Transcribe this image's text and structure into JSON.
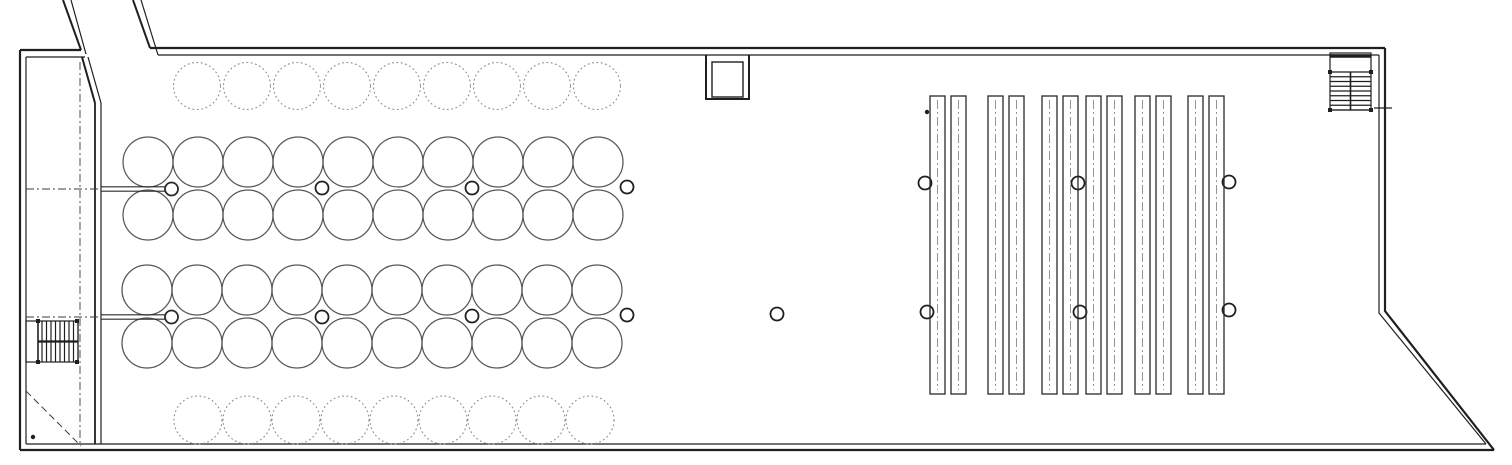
{
  "page": {
    "background": "#ffffff"
  },
  "plan": {
    "canvas": {
      "w": 1512,
      "h": 465
    },
    "ink": "#1f1f1f",
    "walls": {
      "color": "#1f1f1f",
      "segments": [
        {
          "d": "M150 48 H1385",
          "w": 2.2
        },
        {
          "d": "M158 55 H1379",
          "w": 1.2
        },
        {
          "d": "M1385 48 V311 L1494 450",
          "w": 2.2
        },
        {
          "d": "M1379 55 V313 L1486 444",
          "w": 1.2
        },
        {
          "d": "M20 450 H1494",
          "w": 2.2
        },
        {
          "d": "M26 444 H1486",
          "w": 1.2
        },
        {
          "d": "M20 50 V450",
          "w": 2.2
        },
        {
          "d": "M26 57 V444",
          "w": 1.2
        },
        {
          "d": "M20 50 H81",
          "w": 2.2
        },
        {
          "d": "M26 57 H85",
          "w": 1.2
        },
        {
          "d": "M63 0 L81 50",
          "w": 2.0
        },
        {
          "d": "M71 0 L86 54",
          "w": 1.2
        },
        {
          "d": "M133 0 L150 48",
          "w": 2.0
        },
        {
          "d": "M141 0 L158 55",
          "w": 1.2
        },
        {
          "d": "M82 57 L95 103",
          "w": 2.0
        },
        {
          "d": "M88 57 L101 103",
          "w": 1.2
        },
        {
          "d": "M95 103 V444",
          "w": 1.8
        },
        {
          "d": "M101 103 V444",
          "w": 1.2
        }
      ]
    },
    "centerlines": {
      "color": "#3c3c3c",
      "width": 0.9,
      "dash": "8 3 2 3",
      "lines": [
        "M26 189 H101",
        "M26 317 H101",
        "M80 62 V443"
      ]
    },
    "ramp_arrow": {
      "color": "#3c3c3c",
      "width": 1.0,
      "dash": "7 4",
      "d": "M26 391 L81 446"
    },
    "tanks": {
      "solid_color": "#575757",
      "solid_width": 1.25,
      "dashed_color": "#8f8f8f",
      "dashed_width": 1.1,
      "dash": "1.8 2.6",
      "rows": [
        {
          "style": "dashed",
          "cy": 86,
          "r": 23.5,
          "start": 197,
          "step": 50,
          "count": 9
        },
        {
          "style": "solid",
          "cy": 162,
          "r": 25,
          "start": 148,
          "step": 50,
          "count": 10
        },
        {
          "style": "solid",
          "cy": 215,
          "r": 25,
          "start": 148,
          "step": 50,
          "count": 10
        },
        {
          "style": "solid",
          "cy": 290,
          "r": 25,
          "start": 147,
          "step": 50,
          "count": 10
        },
        {
          "style": "solid",
          "cy": 343,
          "r": 25,
          "start": 147,
          "step": 50,
          "count": 10
        },
        {
          "style": "dashed",
          "cy": 420,
          "r": 24,
          "start": 198,
          "step": 49,
          "count": 9
        }
      ]
    },
    "pipes": {
      "color": "#2a2a2a",
      "line_width": 1.1,
      "half_gap": 2.2,
      "end_circle_r": 6.5,
      "end_circle_w": 1.8,
      "items": [
        {
          "y": 189,
          "x1": 101,
          "x2": 164.5,
          "cx": 171.5
        },
        {
          "y": 317,
          "x1": 101,
          "x2": 164.5,
          "cx": 171.5
        }
      ]
    },
    "columns": {
      "color": "#1f1f1f",
      "r": 6.5,
      "stroke_w": 1.8,
      "points": [
        [
          322,
          188
        ],
        [
          472,
          188
        ],
        [
          627,
          187
        ],
        [
          925,
          183
        ],
        [
          1078,
          183
        ],
        [
          1229,
          182
        ],
        [
          322,
          317
        ],
        [
          472,
          316
        ],
        [
          627,
          315
        ],
        [
          777,
          314
        ],
        [
          927,
          312
        ],
        [
          1080,
          312
        ],
        [
          1229,
          310
        ]
      ]
    },
    "racks": {
      "color": "#2a2a2a",
      "stroke_w": 1.3,
      "centerline_color": "#7a7a7a",
      "centerline_dash": "9 3 2 3",
      "top": 96,
      "bottom": 394,
      "rect_w": 15,
      "gap": 6,
      "pairs_x": [
        930,
        988,
        1042,
        1086,
        1135,
        1188
      ]
    },
    "shaft": {
      "color": "#1f1f1f",
      "outer": "M706 55 V99 H749 V55",
      "outer_w": 2.0,
      "inner": {
        "x": 712,
        "y": 62,
        "w": 31,
        "h": 35,
        "stroke_w": 1.4
      }
    },
    "stairs_ne": {
      "x": 1330,
      "y": 53,
      "w": 41,
      "h": 57,
      "landing_bar_y": 56,
      "landing_bar_w": 3.5,
      "tread_start": 72,
      "tread_step": 4.75,
      "tread_count": 9,
      "divider_x": 1350.5,
      "posts": [
        [
          1330,
          72
        ],
        [
          1371,
          72
        ],
        [
          1330,
          110
        ],
        [
          1371,
          110
        ]
      ],
      "post_size": 4
    },
    "stairs_sw": {
      "x": 26,
      "y": 321,
      "w": 52,
      "h": 41,
      "rail_x": 38,
      "tread_start": 42,
      "tread_step": 4.5,
      "tread_count": 9,
      "divider_y": 341.5,
      "posts": [
        [
          38,
          321
        ],
        [
          77,
          321
        ],
        [
          38,
          362
        ],
        [
          77,
          362
        ]
      ],
      "post_size": 4
    },
    "dots": {
      "color": "#1f1f1f",
      "r": 2.2,
      "points": [
        [
          33,
          437
        ],
        [
          927,
          112
        ]
      ]
    },
    "wall_tick": {
      "d": "M1374 108 H1392",
      "w": 1.2,
      "color": "#1f1f1f"
    }
  }
}
